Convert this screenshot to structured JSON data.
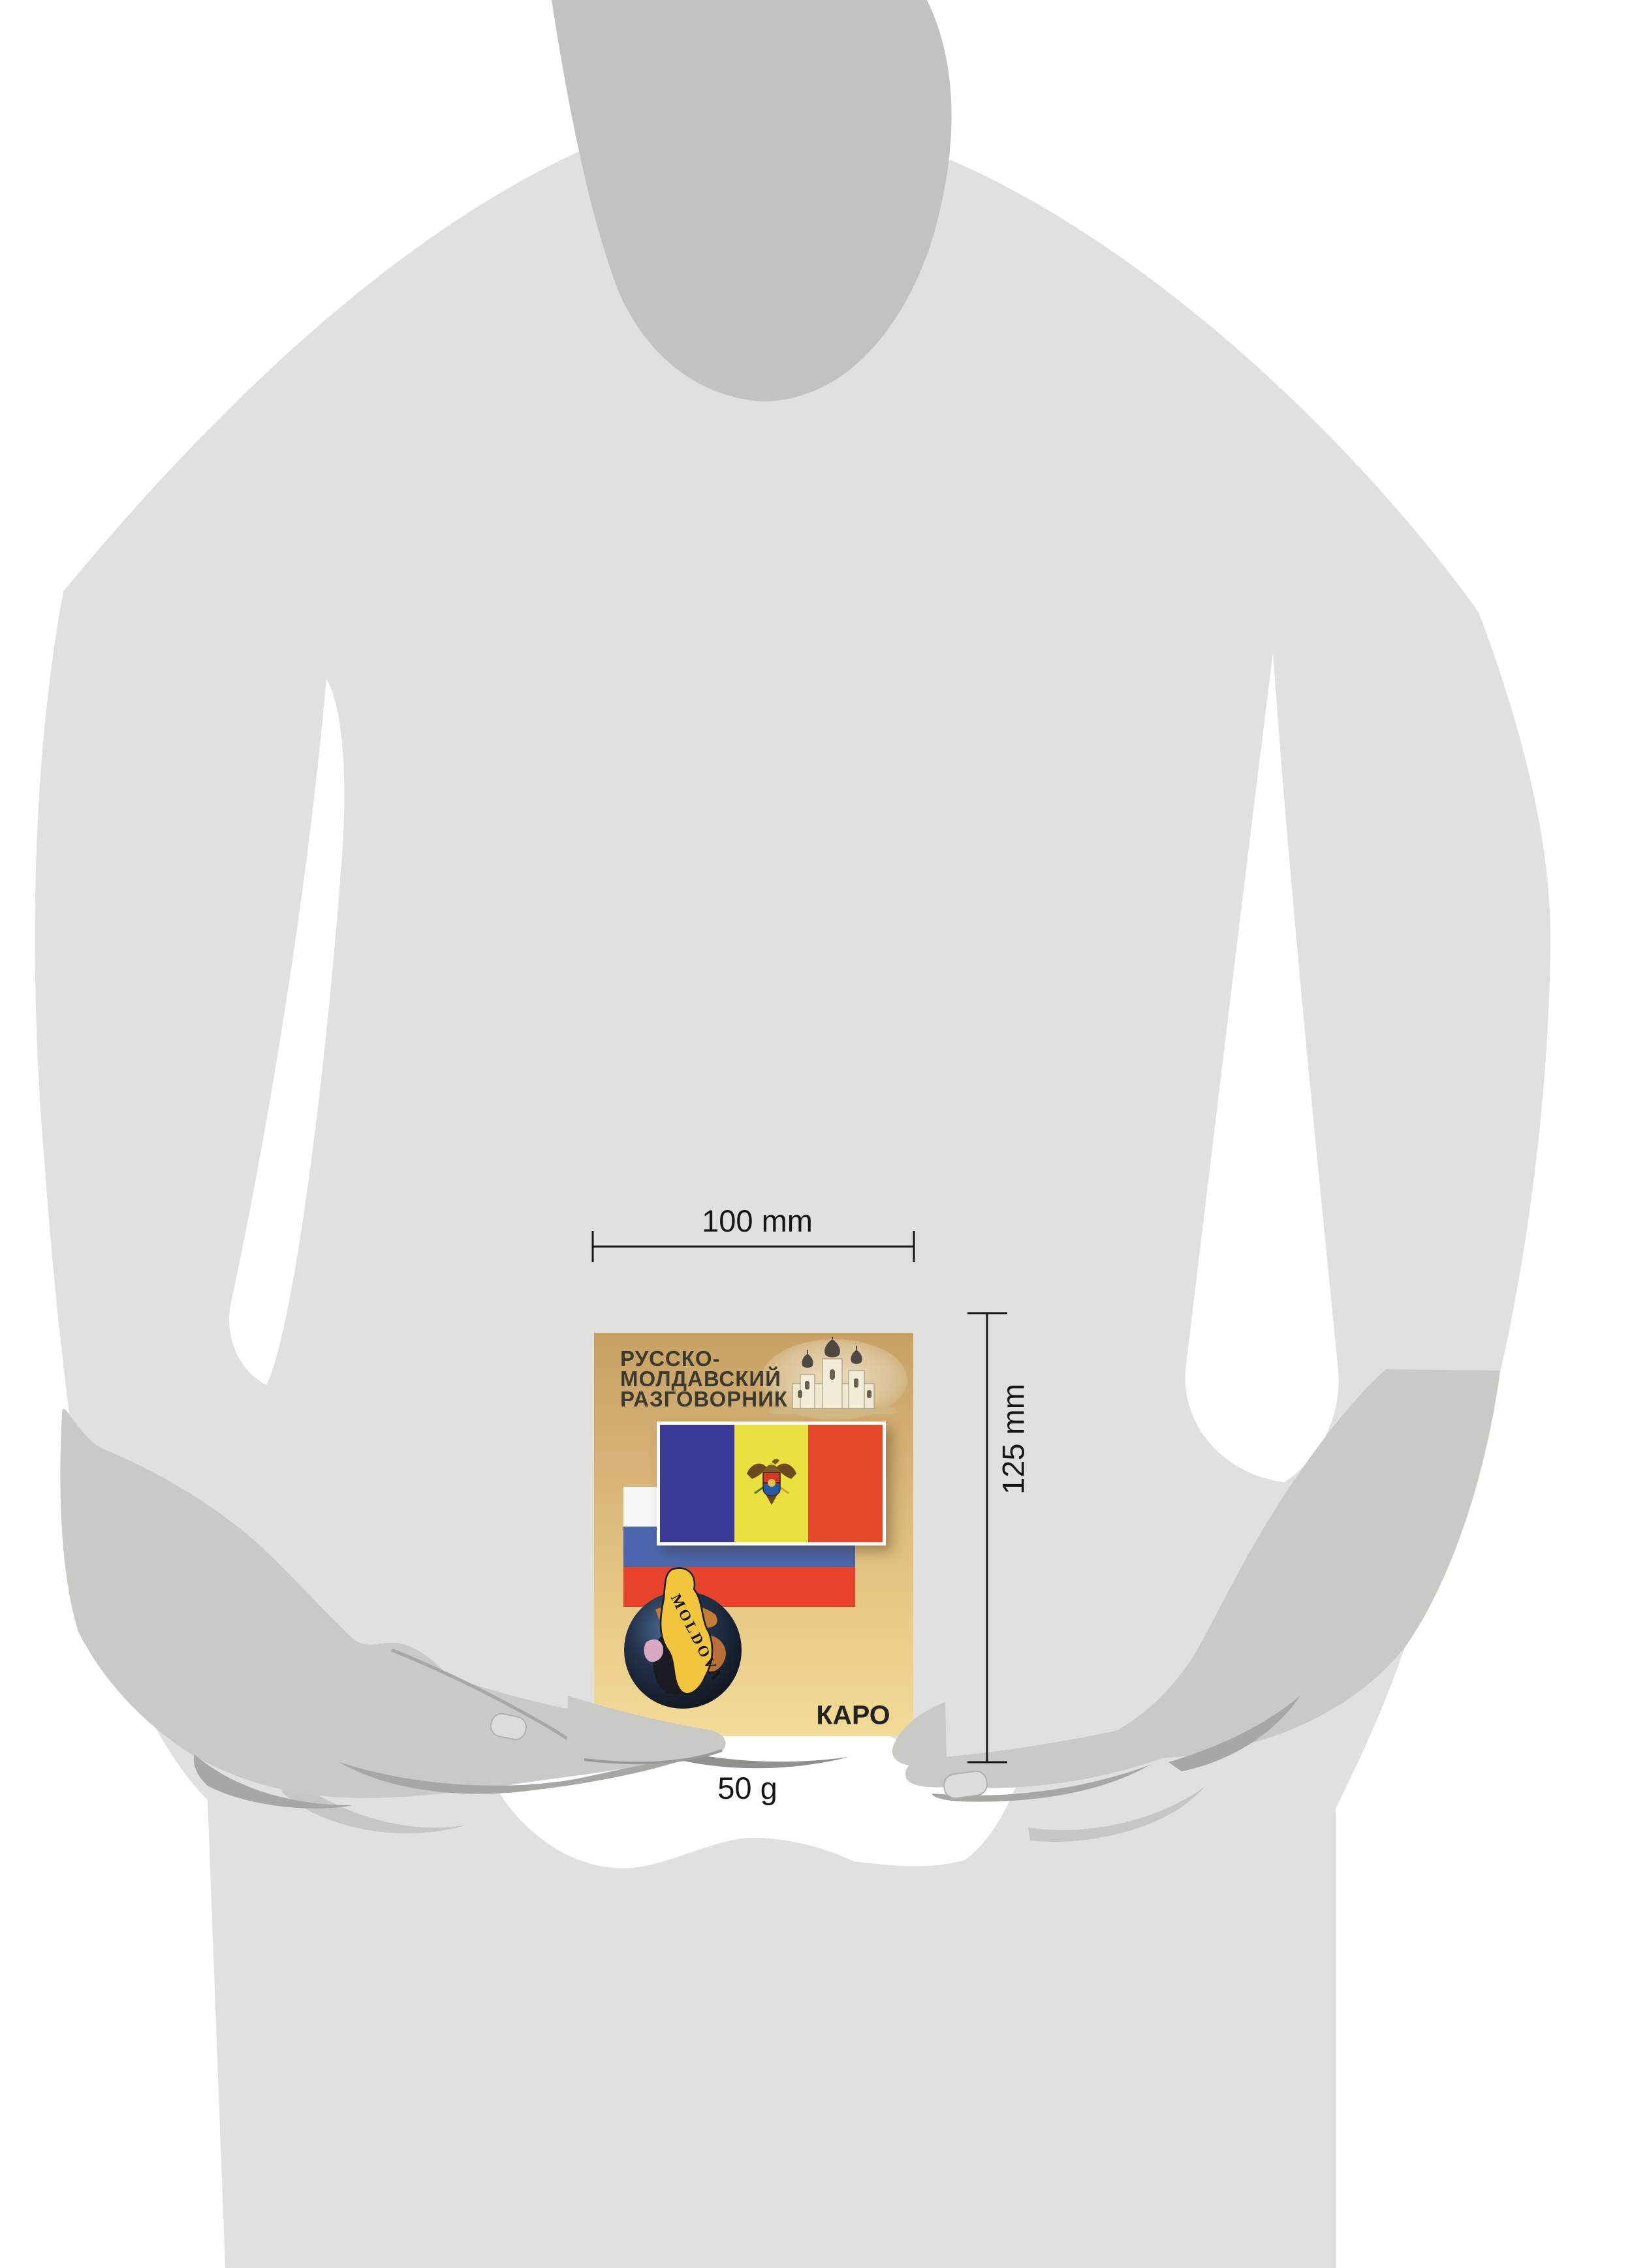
{
  "scene": {
    "description": "size-reference diagram: gray person silhouette holding a small book",
    "figure": "person-silhouette"
  },
  "dimensions": {
    "width_label": "100 mm",
    "height_label": "125 mm",
    "weight_label": "50 g"
  },
  "book": {
    "title_line1": "РУССКО-",
    "title_line2": "МОЛДАВСКИЙ",
    "title_line3": "РАЗГОВОРНИК",
    "publisher": "КАРО",
    "map_label": "MOLDOVA"
  },
  "colors": {
    "background": "#ffffff",
    "body_gray": "#e0e0de",
    "neck_gray": "#c2c2c0",
    "hand_gray": "#c9c9c6",
    "crease_gray": "#a7a7a4",
    "dimension_line": "#161616",
    "cover_top": "#c8a164",
    "cover_bottom": "#f3db98",
    "title_text": "#3a3a31",
    "moldova_blue": "#3c3a99",
    "moldova_yellow": "#ebe13e",
    "moldova_red": "#e7492b",
    "russia_white": "#f7f7f4",
    "russia_blue": "#4a67ae",
    "russia_red": "#e7432b",
    "map_yellow": "#f1c63d",
    "dome_dark": "#4e4842"
  }
}
